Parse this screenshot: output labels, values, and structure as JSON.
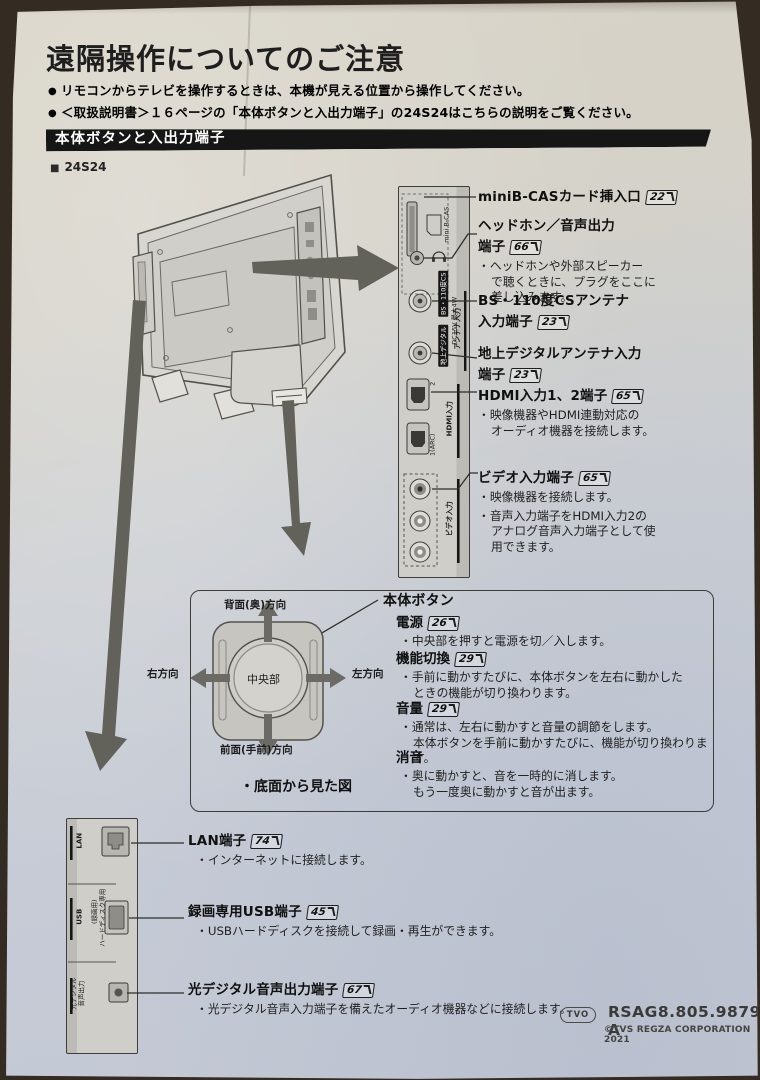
{
  "header": {
    "title": "遠隔操作についてのご注意",
    "note1": "リモコンからテレビを操作するときは、本機が見える位置から操作してください。",
    "note2": "＜取扱説明書＞１６ページの「本体ボタンと入出力端子」の24S24はこちらの説明をご覧ください。",
    "section_title": "本体ボタンと入出力端子",
    "model": "24S24"
  },
  "side_labels": {
    "bcas": "mini B-CAS",
    "bs": "BS・110度CS",
    "dc": "DC15V 最大4W",
    "antenna": "アンテナ入力",
    "terrestrial": "地上デジタル",
    "hdmi_port2": "2",
    "hdmi_port1": "1(ARC)",
    "hdmi": "HDMI入力",
    "video": "ビデオ入力"
  },
  "right_terminals": [
    {
      "label": "miniB-CASカード挿入口",
      "page": "22"
    },
    {
      "label": "ヘッドホン／音声出力",
      "label2": "端子",
      "page": "66",
      "bullet1": "ヘッドホンや外部スピーカー\nで聴くときに、プラグをここに\n差し込みます。"
    },
    {
      "label": "BS・110度CSアンテナ",
      "label2": "入力端子",
      "page": "23"
    },
    {
      "label": "地上デジタルアンテナ入力",
      "label2": "端子",
      "page": "23"
    },
    {
      "label": "HDMI入力1、2端子",
      "page": "65",
      "bullet1": "映像機器やHDMI連動対応の\nオーディオ機器を接続します。"
    },
    {
      "label": "ビデオ入力端子",
      "page": "65",
      "bullet1": "映像機器を接続します。",
      "bullet2": "音声入力端子をHDMI入力2の\nアナログ音声入力端子として使\n用できます。"
    }
  ],
  "button_section": {
    "dir_top": "背面(奥)方向",
    "dir_bottom": "前面(手前)方向",
    "dir_left": "右方向",
    "dir_right": "左方向",
    "center": "中央部",
    "caption": "・底面から見た図",
    "title": "本体ボタン",
    "fn1": {
      "name": "電源",
      "page": "26",
      "bullet": "中央部を押すと電源を切／入します。"
    },
    "fn2": {
      "name": "機能切換",
      "page": "29",
      "bullet": "手前に動かすたびに、本体ボタンを左右に動かした\nときの機能が切り換わります。"
    },
    "fn3": {
      "name": "音量",
      "page": "29",
      "bullet": "通常は、左右に動かすと音量の調節をします。\n本体ボタンを手前に動かすたびに、機能が切り換わります。"
    },
    "fn4": {
      "name": "消音",
      "bullet": "奥に動かすと、音を一時的に消します。\nもう一度奥に動かすと音が出ます。"
    }
  },
  "bottom_labels": {
    "lan": "LAN",
    "rec": "(録画用)",
    "usb": "USB",
    "hdd": "ハードディスク専用",
    "optical": "光デジタル\n音声出力"
  },
  "bottom_terminals": [
    {
      "label": "LAN端子",
      "page": "74",
      "bullet": "インターネットに接続します。"
    },
    {
      "label": "録画専用USB端子",
      "page": "45",
      "bullet": "USBハードディスクを接続して録画・再生ができます。"
    },
    {
      "label": "光デジタル音声出力端子",
      "page": "67",
      "bullet": "光デジタル音声入力端子を備えたオーディオ機器などに接続します。"
    }
  ],
  "footer": {
    "badge": "TVO",
    "part_number": "RSAG8.805.9879 A",
    "copyright": "©TVS REGZA CORPORATION 2021"
  }
}
